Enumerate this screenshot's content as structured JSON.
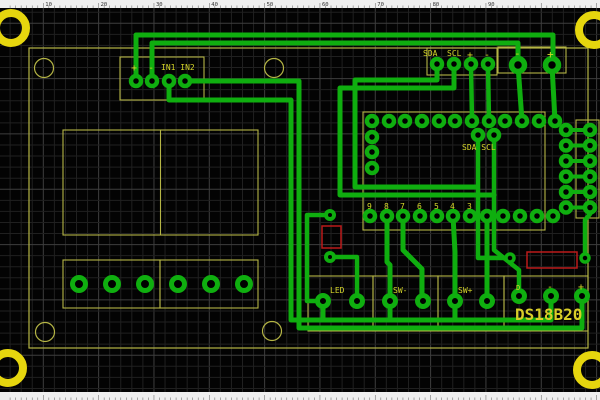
{
  "app": {
    "title": "PCB layout editor canvas",
    "colors": {
      "canvas": "#030303",
      "grid_minor": "#202020",
      "grid_major": "#3e3e3e",
      "trace": "#0fae0f",
      "pad": "#0fae0f",
      "silk": "#b5b545",
      "label": "#d6d62a",
      "big_label": "#d9ce28",
      "mount_ring": "#e6d60e",
      "red_outline": "#bb1a1a",
      "ruler_bg": "#efefef",
      "ruler_tick": "#777777",
      "ruler_text": "#333333"
    }
  },
  "ruler": {
    "numbers": [
      "10",
      "20",
      "30",
      "40",
      "50",
      "60",
      "70",
      "80",
      "90"
    ],
    "spacing": 55.33,
    "first_number_x": 43.3,
    "height": 8
  },
  "board": {
    "labels": {
      "in_plus": "+",
      "in_minus": "-",
      "in1in2": "IN1 IN2",
      "sda": "SDA",
      "scl": "SCL",
      "sda_plus": "+",
      "sda_minus": "-",
      "pwr_minus": "-",
      "pwr_plus": "+",
      "mcu_sda_scl": "SDA SCL",
      "led": "LED",
      "sw_minus": "SW-",
      "sw_plus": "SW+",
      "ds_d": "D",
      "ds_minus": "-",
      "ds_plus": "+",
      "ds18b20": "DS18B20"
    },
    "pin_numbers": [
      "9",
      "8",
      "7",
      "6",
      "5",
      "4",
      "3"
    ],
    "pin_number_xs": [
      367,
      384,
      400,
      417,
      434,
      450,
      467
    ],
    "pin_number_y": 209,
    "outline": {
      "x": 29,
      "y": 48,
      "w": 559,
      "h": 300
    },
    "mount_rings": [
      [
        11,
        28
      ],
      [
        594,
        30
      ],
      [
        8,
        368
      ],
      [
        592,
        370
      ]
    ],
    "module_holes": [
      [
        44,
        68
      ],
      [
        274,
        68
      ],
      [
        45,
        332
      ],
      [
        272,
        331
      ]
    ],
    "silk_boxes": [
      {
        "name": "lcd-module-outline",
        "x": 63,
        "y": 130,
        "w": 195,
        "h": 105
      },
      {
        "name": "terminal-block-a-outline",
        "x": 63,
        "y": 260,
        "w": 97,
        "h": 48
      },
      {
        "name": "terminal-block-b-outline",
        "x": 160,
        "y": 260,
        "w": 98,
        "h": 48
      },
      {
        "name": "in-connector-outline",
        "x": 120,
        "y": 57,
        "w": 84,
        "h": 43
      },
      {
        "name": "sda-connector-outline",
        "x": 427,
        "y": 48,
        "w": 70,
        "h": 27
      },
      {
        "name": "power-connector-outline",
        "x": 498,
        "y": 47,
        "w": 68,
        "h": 26
      },
      {
        "name": "mcu-outline",
        "x": 363,
        "y": 112,
        "w": 182,
        "h": 118
      },
      {
        "name": "right-header-outline",
        "x": 576,
        "y": 120,
        "w": 23,
        "h": 98
      },
      {
        "name": "led-connector-outline",
        "x": 308,
        "y": 276,
        "w": 65,
        "h": 55
      },
      {
        "name": "sw-minus-connector-outline",
        "x": 373,
        "y": 276,
        "w": 65,
        "h": 55
      },
      {
        "name": "sw-plus-connector-outline",
        "x": 438,
        "y": 276,
        "w": 66,
        "h": 55
      },
      {
        "name": "ds18b20-connector-outline",
        "x": 504,
        "y": 276,
        "w": 84,
        "h": 55
      }
    ],
    "silk_lines": [
      {
        "name": "lcd-divider",
        "x1": 160.5,
        "y1": 130,
        "x2": 160.5,
        "y2": 235
      }
    ],
    "red_rects": [
      {
        "name": "resistor-r1-outline",
        "x": 322,
        "y": 226,
        "w": 19,
        "h": 22
      },
      {
        "name": "resistor-r2-outline",
        "x": 527,
        "y": 252,
        "w": 50,
        "h": 16
      }
    ],
    "pad_groups": [
      {
        "name": "in-connector-pad",
        "r": 5,
        "sw": 4.5,
        "pads": [
          [
            136,
            81
          ],
          [
            152,
            81
          ],
          [
            169,
            81
          ],
          [
            185,
            81
          ]
        ]
      },
      {
        "name": "sda-connector-pad",
        "r": 5,
        "sw": 4.5,
        "pads": [
          [
            437,
            64
          ],
          [
            454,
            64
          ],
          [
            471,
            64
          ],
          [
            488,
            64
          ]
        ]
      },
      {
        "name": "power-connector-pad",
        "r": 6.5,
        "sw": 5.5,
        "pads": [
          [
            518,
            65
          ],
          [
            552,
            65
          ]
        ]
      },
      {
        "name": "mcu-top-pad",
        "r": 5,
        "sw": 4.5,
        "pads": [
          [
            372,
            121
          ],
          [
            389,
            121
          ],
          [
            405,
            121
          ],
          [
            422,
            121
          ],
          [
            439,
            121
          ],
          [
            455,
            121
          ],
          [
            472,
            121
          ],
          [
            489,
            121
          ],
          [
            505,
            121
          ],
          [
            522,
            121
          ],
          [
            539,
            121
          ],
          [
            555,
            121
          ]
        ]
      },
      {
        "name": "mcu-bottom-pad",
        "r": 5,
        "sw": 4.5,
        "pads": [
          [
            370,
            216
          ],
          [
            387,
            216
          ],
          [
            403,
            216
          ],
          [
            420,
            216
          ],
          [
            437,
            216
          ],
          [
            453,
            216
          ],
          [
            470,
            216
          ],
          [
            487,
            216
          ],
          [
            503,
            216
          ],
          [
            520,
            216
          ],
          [
            537,
            216
          ],
          [
            553,
            216
          ]
        ]
      },
      {
        "name": "mcu-left-pad",
        "r": 5,
        "sw": 4.5,
        "pads": [
          [
            372,
            137
          ],
          [
            372,
            152
          ],
          [
            372,
            168
          ]
        ]
      },
      {
        "name": "mcu-sda-scl-pad",
        "r": 5,
        "sw": 4.5,
        "pads": [
          [
            478,
            135
          ],
          [
            494,
            135
          ]
        ]
      },
      {
        "name": "right-header-pad",
        "r": 5,
        "sw": 4.5,
        "pads": [
          [
            566,
            130
          ],
          [
            566,
            145.5
          ],
          [
            566,
            161
          ],
          [
            566,
            176.5
          ],
          [
            566,
            192
          ],
          [
            566,
            207.5
          ],
          [
            590,
            130
          ],
          [
            590,
            145.5
          ],
          [
            590,
            161
          ],
          [
            590,
            176.5
          ],
          [
            590,
            192
          ],
          [
            590,
            207.5
          ]
        ]
      },
      {
        "name": "resistor-r1-pad",
        "r": 4,
        "sw": 4,
        "pads": [
          [
            330,
            215
          ],
          [
            330,
            257
          ]
        ]
      },
      {
        "name": "resistor-r2-pad",
        "r": 4,
        "sw": 3.5,
        "pads": [
          [
            510,
            258
          ],
          [
            585,
            258
          ]
        ]
      },
      {
        "name": "led-pad",
        "r": 5.5,
        "sw": 5,
        "pads": [
          [
            323,
            301
          ],
          [
            357,
            301
          ]
        ]
      },
      {
        "name": "sw-minus-pad",
        "r": 5.5,
        "sw": 5,
        "pads": [
          [
            390,
            301
          ],
          [
            423,
            301
          ]
        ]
      },
      {
        "name": "sw-plus-pad",
        "r": 5.5,
        "sw": 5,
        "pads": [
          [
            455,
            301
          ],
          [
            487,
            301
          ]
        ]
      },
      {
        "name": "ds18b20-pad",
        "r": 5.5,
        "sw": 5,
        "pads": [
          [
            519,
            296
          ],
          [
            551,
            296
          ],
          [
            582,
            296
          ]
        ]
      },
      {
        "name": "terminal-block-pad",
        "r": 6.5,
        "sw": 5,
        "pads": [
          [
            79,
            284
          ],
          [
            112,
            284
          ],
          [
            145,
            284
          ],
          [
            178,
            284
          ],
          [
            211,
            284
          ],
          [
            244,
            284
          ]
        ]
      }
    ],
    "traces": [
      {
        "w": 5,
        "pts": [
          [
            136,
            81
          ],
          [
            136,
            35
          ],
          [
            553,
            35
          ],
          [
            553,
            65
          ]
        ]
      },
      {
        "w": 5,
        "pts": [
          [
            152,
            81
          ],
          [
            152,
            43
          ],
          [
            518,
            43
          ],
          [
            518,
            65
          ]
        ]
      },
      {
        "w": 5,
        "pts": [
          [
            169,
            81
          ],
          [
            169,
            100
          ],
          [
            291,
            100
          ],
          [
            291,
            320
          ],
          [
            551,
            320
          ],
          [
            551,
            296
          ]
        ]
      },
      {
        "w": 5,
        "pts": [
          [
            185,
            81
          ],
          [
            299,
            81
          ],
          [
            299,
            328
          ],
          [
            582,
            328
          ],
          [
            582,
            296
          ]
        ]
      },
      {
        "w": 4.5,
        "pts": [
          [
            330,
            215
          ],
          [
            307,
            215
          ],
          [
            307,
            301
          ],
          [
            323,
            301
          ]
        ]
      },
      {
        "w": 4.5,
        "pts": [
          [
            330,
            257
          ],
          [
            357,
            257
          ],
          [
            357,
            301
          ]
        ]
      },
      {
        "w": 5,
        "pts": [
          [
            387,
            216
          ],
          [
            387,
            262
          ],
          [
            390,
            265
          ],
          [
            390,
            301
          ]
        ]
      },
      {
        "w": 5,
        "pts": [
          [
            403,
            216
          ],
          [
            403,
            250
          ],
          [
            422,
            269
          ],
          [
            422,
            301
          ]
        ]
      },
      {
        "w": 5,
        "pts": [
          [
            453,
            216
          ],
          [
            455,
            252
          ],
          [
            455,
            301
          ]
        ]
      },
      {
        "w": 5,
        "pts": [
          [
            487,
            216
          ],
          [
            487,
            301
          ]
        ]
      },
      {
        "w": 5,
        "pts": [
          [
            437,
            64
          ],
          [
            437,
            80
          ],
          [
            355,
            80
          ],
          [
            355,
            187
          ],
          [
            477,
            187
          ]
        ]
      },
      {
        "w": 5,
        "pts": [
          [
            454,
            64
          ],
          [
            454,
            88
          ],
          [
            340,
            88
          ],
          [
            340,
            195
          ],
          [
            494,
            195
          ]
        ]
      },
      {
        "w": 4.5,
        "pts": [
          [
            471,
            64
          ],
          [
            472,
            121
          ]
        ]
      },
      {
        "w": 4.5,
        "pts": [
          [
            488,
            64
          ],
          [
            489,
            121
          ]
        ]
      },
      {
        "w": 5,
        "pts": [
          [
            518,
            65
          ],
          [
            522,
            121
          ]
        ]
      },
      {
        "w": 5,
        "pts": [
          [
            552,
            65
          ],
          [
            555,
            121
          ]
        ]
      },
      {
        "w": 4.5,
        "pts": [
          [
            478,
            135
          ],
          [
            478,
            258
          ],
          [
            510,
            258
          ]
        ]
      },
      {
        "w": 4.5,
        "pts": [
          [
            494,
            135
          ],
          [
            494,
            250
          ],
          [
            519,
            270
          ],
          [
            519,
            296
          ]
        ]
      },
      {
        "w": 4.5,
        "pts": [
          [
            585,
            258
          ],
          [
            585,
            220
          ],
          [
            590,
            214
          ],
          [
            590,
            208
          ]
        ]
      },
      {
        "w": 5,
        "pts": [
          [
            323,
            301
          ],
          [
            323,
            320
          ]
        ]
      },
      {
        "w": 5,
        "pts": [
          [
            390,
            301
          ],
          [
            390,
            320
          ]
        ]
      },
      {
        "w": 5,
        "pts": [
          [
            455,
            301
          ],
          [
            455,
            320
          ]
        ]
      },
      {
        "w": 4,
        "pts": [
          [
            566,
            130
          ],
          [
            590,
            130
          ]
        ]
      },
      {
        "w": 4,
        "pts": [
          [
            566,
            145.5
          ],
          [
            590,
            145.5
          ]
        ]
      },
      {
        "w": 4,
        "pts": [
          [
            566,
            161
          ],
          [
            590,
            161
          ]
        ]
      },
      {
        "w": 4,
        "pts": [
          [
            566,
            176.5
          ],
          [
            590,
            176.5
          ]
        ]
      },
      {
        "w": 4,
        "pts": [
          [
            566,
            192
          ],
          [
            590,
            192
          ]
        ]
      },
      {
        "w": 4,
        "pts": [
          [
            566,
            207.5
          ],
          [
            590,
            207.5
          ]
        ]
      }
    ],
    "texts": [
      {
        "bind": "in_plus",
        "x": 131,
        "y": 71,
        "size": 10,
        "name": "in-plus-label"
      },
      {
        "bind": "in_minus",
        "x": 148,
        "y": 71,
        "size": 10,
        "name": "in-minus-label"
      },
      {
        "bind": "in1in2",
        "x": 161,
        "y": 70,
        "size": 8,
        "name": "in1-in2-label"
      },
      {
        "bind": "sda",
        "x": 423,
        "y": 56,
        "size": 8,
        "name": "sda-label"
      },
      {
        "bind": "scl",
        "x": 447,
        "y": 56,
        "size": 8,
        "name": "scl-label"
      },
      {
        "bind": "sda_plus",
        "x": 467,
        "y": 58,
        "size": 10,
        "name": "sda-plus-label"
      },
      {
        "bind": "sda_minus",
        "x": 484,
        "y": 58,
        "size": 10,
        "name": "sda-minus-label"
      },
      {
        "bind": "pwr_minus",
        "x": 514,
        "y": 57,
        "size": 11,
        "name": "power-minus-label"
      },
      {
        "bind": "pwr_plus",
        "x": 547,
        "y": 58,
        "size": 11,
        "name": "power-plus-label"
      },
      {
        "bind": "mcu_sda_scl",
        "x": 462,
        "y": 150,
        "size": 8,
        "name": "mcu-sda-scl-label"
      },
      {
        "bind": "led",
        "x": 330,
        "y": 293,
        "size": 8,
        "name": "led-label"
      },
      {
        "bind": "sw_minus",
        "x": 393,
        "y": 293,
        "size": 8,
        "name": "sw-minus-label"
      },
      {
        "bind": "sw_plus",
        "x": 458,
        "y": 293,
        "size": 8,
        "name": "sw-plus-label"
      },
      {
        "bind": "ds_d",
        "x": 516,
        "y": 290,
        "size": 7,
        "name": "ds18b20-d-label"
      },
      {
        "bind": "ds_minus",
        "x": 547,
        "y": 290,
        "size": 10,
        "name": "ds18b20-minus-label"
      },
      {
        "bind": "ds_plus",
        "x": 578,
        "y": 290,
        "size": 10,
        "name": "ds18b20-plus-label"
      },
      {
        "bind": "ds18b20",
        "x": 515,
        "y": 320,
        "size": 16,
        "bold": true,
        "name": "ds18b20-label"
      }
    ]
  }
}
